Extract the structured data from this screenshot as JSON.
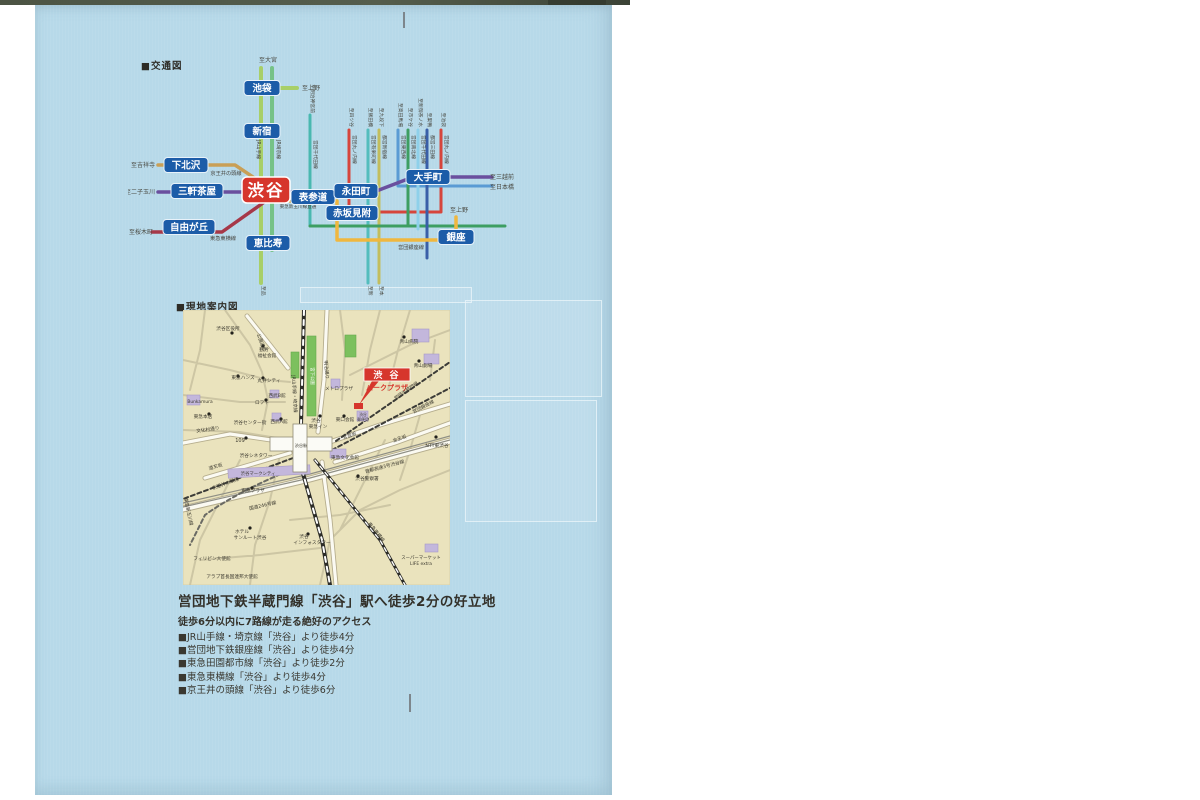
{
  "page": {
    "background": "#ffffff",
    "paper_color": "#b7d9e9",
    "accent_red": "#d6362c",
    "station_blue": "#1c5ca8"
  },
  "transit": {
    "header": "■交通図",
    "shibuya": {
      "label": "渋谷",
      "x": 266,
      "y": 190
    },
    "stations": [
      {
        "id": "ikebukuro",
        "label": "池袋",
        "x": 262,
        "y": 88,
        "w": 36
      },
      {
        "id": "shinjuku",
        "label": "新宿",
        "x": 262,
        "y": 131,
        "w": 36
      },
      {
        "id": "shimokitazawa",
        "label": "下北沢",
        "x": 186,
        "y": 165,
        "w": 44
      },
      {
        "id": "sangenjaya",
        "label": "三軒茶屋",
        "x": 197,
        "y": 191,
        "w": 52
      },
      {
        "id": "omotesando",
        "label": "表参道",
        "x": 313,
        "y": 197,
        "w": 44
      },
      {
        "id": "nagatacho",
        "label": "永田町",
        "x": 356,
        "y": 191,
        "w": 44
      },
      {
        "id": "akasakamitsuke",
        "label": "赤坂見附",
        "x": 352,
        "y": 213,
        "w": 52
      },
      {
        "id": "otemachi",
        "label": "大手町",
        "x": 428,
        "y": 177,
        "w": 44
      },
      {
        "id": "ginza",
        "label": "銀座",
        "x": 456,
        "y": 237,
        "w": 36
      },
      {
        "id": "jiyugaoka",
        "label": "自由が丘",
        "x": 189,
        "y": 227,
        "w": 52
      },
      {
        "id": "ebisu",
        "label": "恵比寿",
        "x": 268,
        "y": 243,
        "w": 44
      }
    ],
    "endpoints": [
      {
        "text": "至大宮",
        "x": 268,
        "y": 62
      },
      {
        "text": "至上野",
        "x": 311,
        "y": 90
      },
      {
        "text": "至吉祥寺",
        "x": 143,
        "y": 167
      },
      {
        "text": "至二子玉川",
        "x": 140,
        "y": 194
      },
      {
        "text": "至桜木町",
        "x": 141,
        "y": 234
      },
      {
        "text": "至三越前",
        "x": 502,
        "y": 179
      },
      {
        "text": "至日本橋",
        "x": 502,
        "y": 189
      },
      {
        "text": "至上野",
        "x": 459,
        "y": 212
      }
    ],
    "top_labels": [
      {
        "text": "至明治神宮前",
        "x": 311,
        "y": 113
      },
      {
        "text": "至四ツ谷",
        "x": 350,
        "y": 127
      },
      {
        "text": "至飯田橋",
        "x": 369,
        "y": 127
      },
      {
        "text": "至九段下",
        "x": 380,
        "y": 127
      },
      {
        "text": "至高田馬場",
        "x": 399,
        "y": 127
      },
      {
        "text": "至市ケ谷",
        "x": 409,
        "y": 127
      },
      {
        "text": "至新御茶ノ水",
        "x": 419,
        "y": 127
      },
      {
        "text": "至巣鴨",
        "x": 428,
        "y": 127
      },
      {
        "text": "至池袋",
        "x": 442,
        "y": 127
      }
    ],
    "line_names": [
      {
        "text": "JR山手線",
        "x": 257,
        "y": 140
      },
      {
        "text": "JR埼京線",
        "x": 277,
        "y": 140
      },
      {
        "text": "営団千代田線",
        "x": 314,
        "y": 140
      },
      {
        "text": "営団丸ノ内線",
        "x": 353,
        "y": 135
      },
      {
        "text": "営団有楽町線",
        "x": 372,
        "y": 135
      },
      {
        "text": "都営新宿線",
        "x": 383,
        "y": 135
      },
      {
        "text": "営団東西線",
        "x": 402,
        "y": 135
      },
      {
        "text": "営団南北線",
        "x": 412,
        "y": 135
      },
      {
        "text": "営団千代田線",
        "x": 422,
        "y": 135
      },
      {
        "text": "都営三田線",
        "x": 431,
        "y": 135
      },
      {
        "text": "営団丸ノ内線",
        "x": 445,
        "y": 135
      }
    ],
    "bottom_labels": [
      {
        "text": "至品川",
        "x": 262,
        "y": 286
      },
      {
        "text": "至新木場",
        "x": 369,
        "y": 286
      },
      {
        "text": "至本八幡",
        "x": 380,
        "y": 286
      }
    ],
    "route_labels": [
      {
        "text": "京王井の頭線",
        "x": 226,
        "y": 175
      },
      {
        "text": "営団半蔵門線",
        "x": 293,
        "y": 202,
        "size": 4.6
      },
      {
        "text": "東急新玉川線直通",
        "x": 298,
        "y": 208,
        "size": 4.6
      },
      {
        "text": "東急東横線",
        "x": 223,
        "y": 240
      },
      {
        "text": "営団銀座線",
        "x": 411,
        "y": 249
      }
    ]
  },
  "map": {
    "header": "■現地案内図",
    "property": {
      "line1": "渋 谷",
      "line2": "パークプラザ"
    },
    "labels": [
      {
        "text": "渋谷区役所",
        "x": 228,
        "y": 330
      },
      {
        "text": "公園通り",
        "x": 260,
        "y": 343,
        "rot": 70
      },
      {
        "text": "勤労",
        "x": 264,
        "y": 351
      },
      {
        "text": "福祉会館",
        "x": 267,
        "y": 357
      },
      {
        "text": "東急ハンズ",
        "x": 243,
        "y": 379
      },
      {
        "text": "丸井シティ",
        "x": 269,
        "y": 382
      },
      {
        "text": "ロフト",
        "x": 262,
        "y": 404
      },
      {
        "text": "Bunkamura",
        "x": 200,
        "y": 403,
        "size": 4.4
      },
      {
        "text": "東急本店",
        "x": 203,
        "y": 418
      },
      {
        "text": "渋谷センター街",
        "x": 250,
        "y": 424
      },
      {
        "text": "西武B館",
        "x": 277,
        "y": 397
      },
      {
        "text": "西武A館",
        "x": 279,
        "y": 423
      },
      {
        "text": "文化村通り",
        "x": 208,
        "y": 431,
        "rot": -8
      },
      {
        "text": "109",
        "x": 240,
        "y": 442,
        "size": 5
      },
      {
        "text": "渋谷シネタワー",
        "x": 256,
        "y": 457
      },
      {
        "text": "渋谷マークシティ",
        "x": 258,
        "y": 475,
        "size": 4.4
      },
      {
        "text": "道玄坂",
        "x": 216,
        "y": 468,
        "rot": -16
      },
      {
        "text": "京王井の頭線",
        "x": 226,
        "y": 485,
        "rot": -20
      },
      {
        "text": "東急新玉川線",
        "x": 187,
        "y": 512,
        "rot": 78
      },
      {
        "text": "東急プラザ",
        "x": 253,
        "y": 492
      },
      {
        "text": "国道246号線",
        "x": 263,
        "y": 507,
        "rot": -13
      },
      {
        "text": "ホテル",
        "x": 242,
        "y": 533
      },
      {
        "text": "サンルート渋谷",
        "x": 250,
        "y": 539
      },
      {
        "text": "渋谷",
        "x": 304,
        "y": 538
      },
      {
        "text": "インフォスタワー",
        "x": 312,
        "y": 544
      },
      {
        "text": "フィリピン大使館",
        "x": 212,
        "y": 560
      },
      {
        "text": "アラブ首長国連邦大使館",
        "x": 232,
        "y": 578
      },
      {
        "text": "JR山手線・埼京線",
        "x": 293,
        "y": 394,
        "rot": 87
      },
      {
        "text": "宮下公園",
        "x": 311,
        "y": 376,
        "rot": 90,
        "color": "#ffffff",
        "size": 4.4
      },
      {
        "text": "明治通り",
        "x": 325,
        "y": 370,
        "rot": 85
      },
      {
        "text": "メトロプラザ",
        "x": 339,
        "y": 390
      },
      {
        "text": "渋谷",
        "x": 316,
        "y": 422
      },
      {
        "text": "東急イン",
        "x": 318,
        "y": 428
      },
      {
        "text": "東口会館",
        "x": 345,
        "y": 421
      },
      {
        "text": "渋谷",
        "x": 363,
        "y": 416,
        "size": 3.8
      },
      {
        "text": "郵便局",
        "x": 363,
        "y": 421,
        "size": 3.8
      },
      {
        "text": "東急文化会館",
        "x": 345,
        "y": 459
      },
      {
        "text": "宮益坂",
        "x": 350,
        "y": 437,
        "rot": -18
      },
      {
        "text": "渋谷警察署",
        "x": 367,
        "y": 480
      },
      {
        "text": "首都高速3号渋谷線",
        "x": 385,
        "y": 468,
        "rot": -15
      },
      {
        "text": "金王坂",
        "x": 400,
        "y": 440,
        "rot": -19
      },
      {
        "text": "NTT東渋谷",
        "x": 437,
        "y": 447
      },
      {
        "text": "青山病院",
        "x": 409,
        "y": 343
      },
      {
        "text": "青山劇場",
        "x": 423,
        "y": 367
      },
      {
        "text": "営団半蔵門線",
        "x": 407,
        "y": 392,
        "rot": -35
      },
      {
        "text": "営団銀座線",
        "x": 424,
        "y": 408,
        "rot": -28
      },
      {
        "text": "東急東横線",
        "x": 375,
        "y": 533,
        "rot": 51
      },
      {
        "text": "スーパーマーケット",
        "x": 421,
        "y": 559,
        "size": 4.4
      },
      {
        "text": "LIFE extra",
        "x": 421,
        "y": 565,
        "size": 4.4
      },
      {
        "text": "渋谷駅",
        "x": 301,
        "y": 447,
        "size": 4.2
      }
    ],
    "dots": [
      {
        "x": 232,
        "y": 333
      },
      {
        "x": 263,
        "y": 346
      },
      {
        "x": 238,
        "y": 376
      },
      {
        "x": 263,
        "y": 378
      },
      {
        "x": 266,
        "y": 400
      },
      {
        "x": 209,
        "y": 414
      },
      {
        "x": 246,
        "y": 438
      },
      {
        "x": 252,
        "y": 488
      },
      {
        "x": 358,
        "y": 476
      },
      {
        "x": 436,
        "y": 437
      },
      {
        "x": 250,
        "y": 528
      },
      {
        "x": 308,
        "y": 534
      },
      {
        "x": 404,
        "y": 337
      },
      {
        "x": 419,
        "y": 361
      },
      {
        "x": 344,
        "y": 416
      },
      {
        "x": 320,
        "y": 416
      },
      {
        "x": 281,
        "y": 419
      }
    ]
  },
  "access": {
    "headline": "営団地下鉄半蔵門線「渋谷」駅へ徒歩2分の好立地",
    "subheadline": "徒歩6分以内に7路線が走る絶好のアクセス",
    "items": [
      "■JR山手線・埼京線「渋谷」より徒歩4分",
      "■営団地下鉄銀座線「渋谷」より徒歩4分",
      "■東急田園都市線「渋谷」より徒歩2分",
      "■東急東横線「渋谷」より徒歩4分",
      "■京王井の頭線「渋谷」より徒歩6分"
    ]
  }
}
